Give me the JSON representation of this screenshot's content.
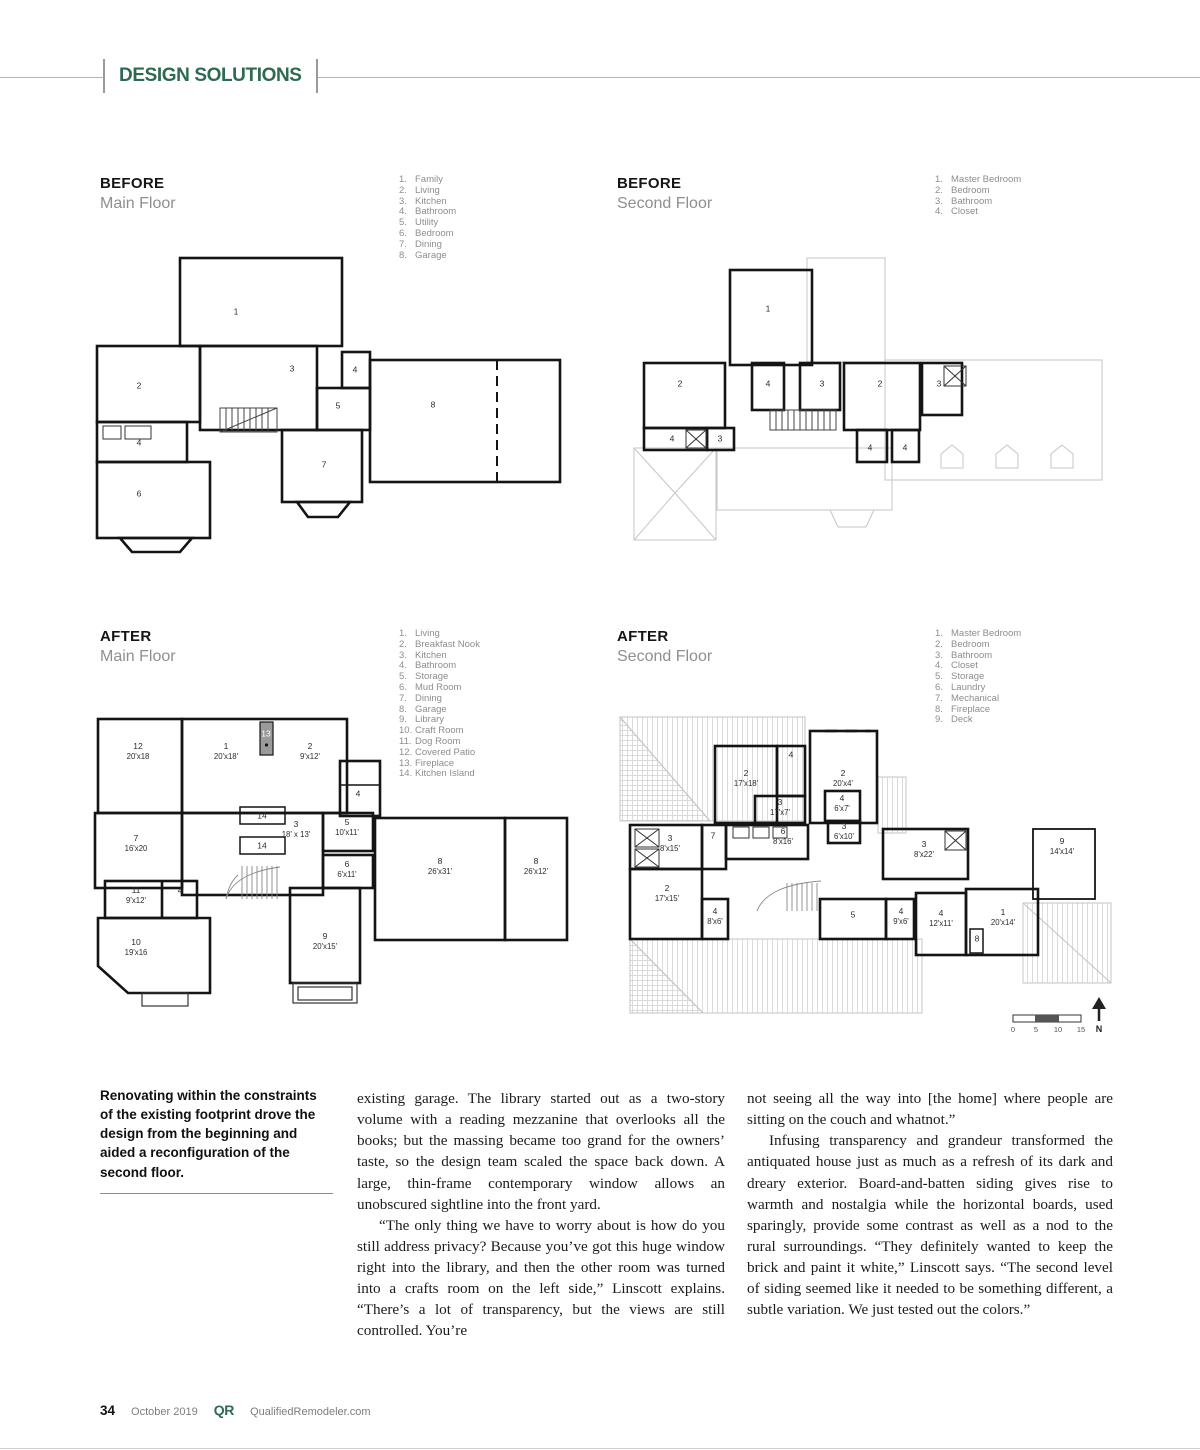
{
  "header": {
    "section_title": "DESIGN SOLUTIONS"
  },
  "colors": {
    "accent_green": "#2e6a52"
  },
  "plans": {
    "before_main": {
      "stage": "BEFORE",
      "floor": "Main Floor",
      "legend": [
        {
          "n": "1.",
          "label": "Family"
        },
        {
          "n": "2.",
          "label": "Living"
        },
        {
          "n": "3.",
          "label": "Kitchen"
        },
        {
          "n": "4.",
          "label": "Bathroom"
        },
        {
          "n": "5.",
          "label": "Utility"
        },
        {
          "n": "6.",
          "label": "Bedroom"
        },
        {
          "n": "7.",
          "label": "Dining"
        },
        {
          "n": "8.",
          "label": "Garage"
        }
      ],
      "rooms": [
        {
          "num": "1",
          "dim": "",
          "x": 144,
          "y": 72
        },
        {
          "num": "2",
          "dim": "",
          "x": 47,
          "y": 146
        },
        {
          "num": "3",
          "dim": "",
          "x": 200,
          "y": 129
        },
        {
          "num": "4",
          "dim": "",
          "x": 263,
          "y": 130
        },
        {
          "num": "5",
          "dim": "",
          "x": 246,
          "y": 166
        },
        {
          "num": "4",
          "dim": "",
          "x": 47,
          "y": 203
        },
        {
          "num": "6",
          "dim": "",
          "x": 47,
          "y": 254
        },
        {
          "num": "7",
          "dim": "",
          "x": 232,
          "y": 225
        },
        {
          "num": "8",
          "dim": "",
          "x": 341,
          "y": 165
        }
      ]
    },
    "before_second": {
      "stage": "BEFORE",
      "floor": "Second Floor",
      "legend": [
        {
          "n": "1.",
          "label": "Master Bedroom"
        },
        {
          "n": "2.",
          "label": "Bedroom"
        },
        {
          "n": "3.",
          "label": "Bathroom"
        },
        {
          "n": "4.",
          "label": "Closet"
        }
      ],
      "rooms": [
        {
          "num": "1",
          "dim": "",
          "x": 146,
          "y": 59
        },
        {
          "num": "2",
          "dim": "",
          "x": 58,
          "y": 134
        },
        {
          "num": "4",
          "dim": "",
          "x": 146,
          "y": 134
        },
        {
          "num": "3",
          "dim": "",
          "x": 200,
          "y": 134
        },
        {
          "num": "2",
          "dim": "",
          "x": 258,
          "y": 134
        },
        {
          "num": "3",
          "dim": "",
          "x": 317,
          "y": 134
        },
        {
          "num": "4",
          "dim": "",
          "x": 50,
          "y": 189
        },
        {
          "num": "3",
          "dim": "",
          "x": 98,
          "y": 189
        },
        {
          "num": "4",
          "dim": "",
          "x": 248,
          "y": 198
        },
        {
          "num": "4",
          "dim": "",
          "x": 283,
          "y": 198
        }
      ]
    },
    "after_main": {
      "stage": "AFTER",
      "floor": "Main Floor",
      "legend": [
        {
          "n": "1.",
          "label": "Living"
        },
        {
          "n": "2.",
          "label": "Breakfast Nook"
        },
        {
          "n": "3.",
          "label": "Kitchen"
        },
        {
          "n": "4.",
          "label": "Bathroom"
        },
        {
          "n": "5.",
          "label": "Storage"
        },
        {
          "n": "6.",
          "label": "Mud Room"
        },
        {
          "n": "7.",
          "label": "Dining"
        },
        {
          "n": "8.",
          "label": "Garage"
        },
        {
          "n": "9.",
          "label": "Library"
        },
        {
          "n": "10.",
          "label": "Craft Room"
        },
        {
          "n": "11.",
          "label": "Dog Room"
        },
        {
          "n": "12.",
          "label": "Covered Patio"
        },
        {
          "n": "13.",
          "label": "Fireplace"
        },
        {
          "n": "14.",
          "label": "Kitchen Island"
        }
      ],
      "rooms": [
        {
          "num": "12",
          "dim": "20'x18",
          "x": 48,
          "y": 48
        },
        {
          "num": "1",
          "dim": "20'x18'",
          "x": 136,
          "y": 48
        },
        {
          "num": "13",
          "dim": "",
          "x": 176,
          "y": 31,
          "light": true
        },
        {
          "num": "2",
          "dim": "9'x12'",
          "x": 220,
          "y": 48
        },
        {
          "num": "4",
          "dim": "",
          "x": 268,
          "y": 91
        },
        {
          "num": "14",
          "dim": "",
          "x": 172,
          "y": 113
        },
        {
          "num": "3",
          "dim": "18' x 13'",
          "x": 206,
          "y": 126
        },
        {
          "num": "5",
          "dim": "10'x11'",
          "x": 257,
          "y": 124
        },
        {
          "num": "7",
          "dim": "16'x20",
          "x": 46,
          "y": 140
        },
        {
          "num": "14",
          "dim": "",
          "x": 172,
          "y": 143
        },
        {
          "num": "6",
          "dim": "6'x11'",
          "x": 257,
          "y": 166
        },
        {
          "num": "8",
          "dim": "26'x31'",
          "x": 350,
          "y": 163
        },
        {
          "num": "8",
          "dim": "26'x12'",
          "x": 446,
          "y": 163
        },
        {
          "num": "11",
          "dim": "9'x12'",
          "x": 46,
          "y": 192
        },
        {
          "num": "4",
          "dim": "",
          "x": 90,
          "y": 188
        },
        {
          "num": "10",
          "dim": "19'x16",
          "x": 46,
          "y": 244
        },
        {
          "num": "9",
          "dim": "20'x15'",
          "x": 235,
          "y": 238
        }
      ]
    },
    "after_second": {
      "stage": "AFTER",
      "floor": "Second Floor",
      "legend": [
        {
          "n": "1.",
          "label": "Master Bedroom"
        },
        {
          "n": "2.",
          "label": "Bedroom"
        },
        {
          "n": "3.",
          "label": "Bathroom"
        },
        {
          "n": "4.",
          "label": "Closet"
        },
        {
          "n": "5.",
          "label": "Storage"
        },
        {
          "n": "6.",
          "label": "Laundry"
        },
        {
          "n": "7.",
          "label": "Mechanical"
        },
        {
          "n": "8.",
          "label": "Fireplace"
        },
        {
          "n": "9.",
          "label": "Deck"
        }
      ],
      "rooms": [
        {
          "num": "2",
          "dim": "17'x18'",
          "x": 131,
          "y": 75
        },
        {
          "num": "4",
          "dim": "",
          "x": 176,
          "y": 52
        },
        {
          "num": "2",
          "dim": "20'x4'",
          "x": 228,
          "y": 75
        },
        {
          "num": "3",
          "dim": "17'x7'",
          "x": 165,
          "y": 104
        },
        {
          "num": "4",
          "dim": "6'x7'",
          "x": 227,
          "y": 100
        },
        {
          "num": "3",
          "dim": "6'x10'",
          "x": 229,
          "y": 128
        },
        {
          "num": "3",
          "dim": "8'x15'",
          "x": 55,
          "y": 140
        },
        {
          "num": "7",
          "dim": "",
          "x": 98,
          "y": 133
        },
        {
          "num": "6",
          "dim": "8'x16'",
          "x": 168,
          "y": 133
        },
        {
          "num": "3",
          "dim": "8'x22'",
          "x": 309,
          "y": 146
        },
        {
          "num": "9",
          "dim": "14'x14'",
          "x": 447,
          "y": 143
        },
        {
          "num": "2",
          "dim": "17'x15'",
          "x": 52,
          "y": 190
        },
        {
          "num": "4",
          "dim": "8'x6'",
          "x": 100,
          "y": 213
        },
        {
          "num": "5",
          "dim": "",
          "x": 238,
          "y": 212
        },
        {
          "num": "4",
          "dim": "9'x6'",
          "x": 286,
          "y": 213
        },
        {
          "num": "4",
          "dim": "12'x11'",
          "x": 326,
          "y": 215
        },
        {
          "num": "1",
          "dim": "20'x14'",
          "x": 388,
          "y": 214
        },
        {
          "num": "8",
          "dim": "",
          "x": 362,
          "y": 236
        }
      ],
      "scale": {
        "ticks": [
          "0",
          "5",
          "10",
          "15"
        ],
        "north": "N"
      }
    }
  },
  "caption": "Renovating within the constraints of the existing footprint drove the design from the beginning and aided a reconfiguration of the second floor.",
  "article": {
    "col1": [
      "existing garage. The library started out as a two-story volume with a reading mezzanine that overlooks all the books; but the massing became too grand for the owners’ taste, so the design team scaled the space back down. A large, thin-frame contemporary window allows an unobscured sightline into the front yard.",
      "“The only thing we have to worry about is how do you still address privacy? Because you’ve got this huge window right into the library, and then the other room was turned into a crafts room on the left side,” Linscott explains. “There’s a lot of transparency, but the views are still controlled. You’re"
    ],
    "col2": [
      "not seeing all the way into [the home] where people are sitting on the couch and whatnot.”",
      "Infusing transparency and grandeur transformed the antiquated house just as much as a refresh of its dark and dreary exterior. Board-and-batten siding gives rise to warmth and nostalgia while the horizontal boards, used sparingly, provide some contrast as well as a nod to the rural surroundings. “They definitely wanted to keep the brick and paint it white,” Linscott says. “The second level of siding seemed like it needed to be something different, a subtle variation. We just tested out the colors.”"
    ]
  },
  "footer": {
    "page_number": "34",
    "issue_date": "October 2019",
    "logo": "QR",
    "website": "QualifiedRemodeler.com"
  }
}
